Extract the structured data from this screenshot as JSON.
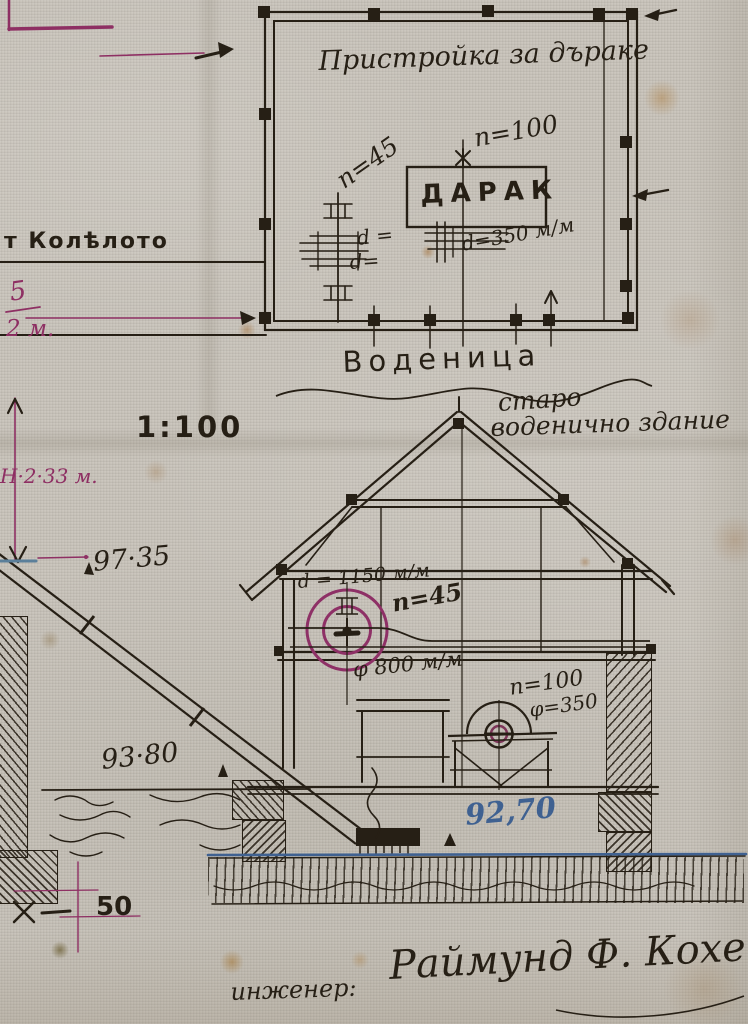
{
  "plan": {
    "title": "Пристройка за дъраке",
    "machine": "ДАРАК",
    "rpm_top": "n=100",
    "rpm_left": "n=45",
    "dia": "d=350 м/м",
    "d1": "d =",
    "d2": "d=",
    "room": "Воденица",
    "note1": "старо",
    "note2": "воденично здание"
  },
  "channel": {
    "label": "т Колѣлото",
    "five": "5",
    "dim": "2 м."
  },
  "scale": {
    "value": "1:100"
  },
  "section": {
    "shaft_dia": "d = 1150 м/м",
    "rpm": "n=45",
    "pulley": "φ 800 м/м",
    "darak_rpm": "n=100",
    "darak_dia": "φ=350"
  },
  "elevations": {
    "height": "Н·2·33 м.",
    "upper": "97·35",
    "ground": "93·80",
    "water": "92,70",
    "fifty": "50"
  },
  "signature": {
    "role": "инженер:",
    "name": "Раймунд Ф. Кохенов"
  },
  "colors": {
    "ink": "#261f15",
    "magenta": "#8e2f63",
    "blue": "#3f6191",
    "paper": "#c6c1b8"
  }
}
